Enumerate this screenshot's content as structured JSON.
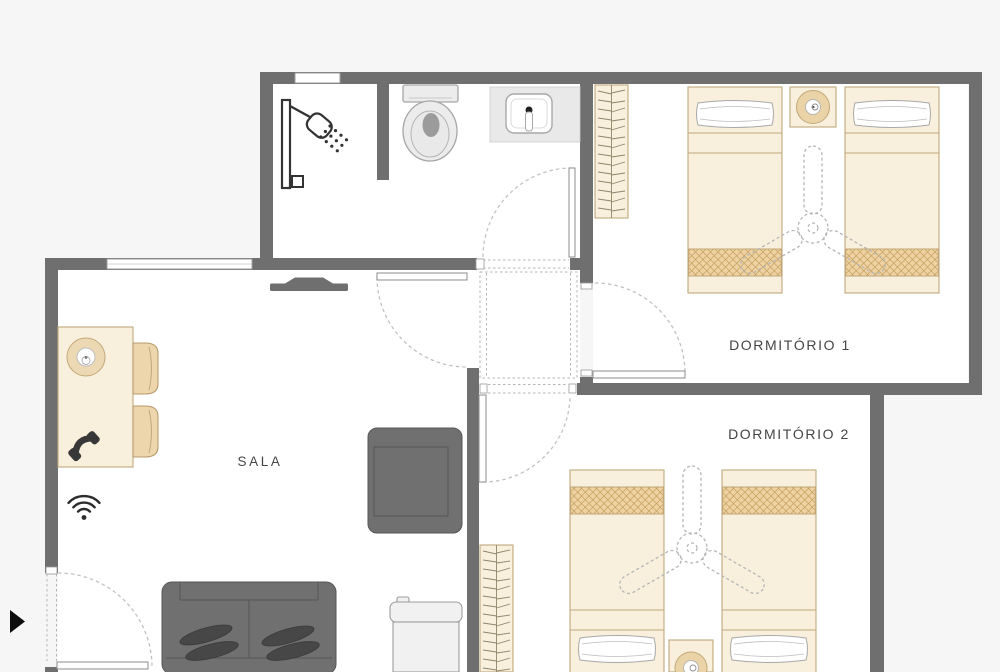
{
  "plan": {
    "type": "apartment-floor-plan",
    "rooms": [
      {
        "id": "sala",
        "label": "SALA"
      },
      {
        "id": "dormitorio-1",
        "label": "DORMITÓRIO 1"
      },
      {
        "id": "dormitorio-2",
        "label": "DORMITÓRIO 2"
      },
      {
        "id": "bathroom",
        "label": ""
      },
      {
        "id": "hallway",
        "label": ""
      }
    ],
    "furniture": {
      "sala": [
        "dining-table",
        "table-lamp",
        "telephone",
        "wifi-signal",
        "dining-chair",
        "dining-chair",
        "tv",
        "armchair",
        "sofa",
        "washing-machine"
      ],
      "bathroom": [
        "shower",
        "toilet",
        "sink"
      ],
      "dormitorio_1": [
        "wardrobe",
        "single-bed",
        "single-bed",
        "nightstand",
        "table-lamp",
        "ceiling-fan"
      ],
      "dormitorio_2": [
        "wardrobe",
        "single-bed",
        "single-bed",
        "nightstand",
        "table-lamp",
        "ceiling-fan"
      ]
    },
    "icons": [
      "shower-icon",
      "toilet-icon",
      "sink-icon",
      "phone-icon",
      "wifi-icon",
      "tv-icon",
      "ceiling-fan-icon",
      "table-lamp-icon",
      "entrance-arrow-icon"
    ]
  },
  "colors": {
    "background": "#f6f6f6",
    "room_fill": "#ffffff",
    "wall": "#6f6f6f",
    "label": "#454545",
    "furniture_fill": "#f8f0dd",
    "furniture_border": "#c0a87c",
    "blanket_fill": "#eed2a2",
    "blanket_hatch": "#c49f5f",
    "dark_furniture": "#707070",
    "cushion": "#474747",
    "appliance": "#f1f1f1",
    "fixture": "#ececec",
    "icon": "#2e2e2e",
    "door_arc": "#c2c2c2"
  }
}
